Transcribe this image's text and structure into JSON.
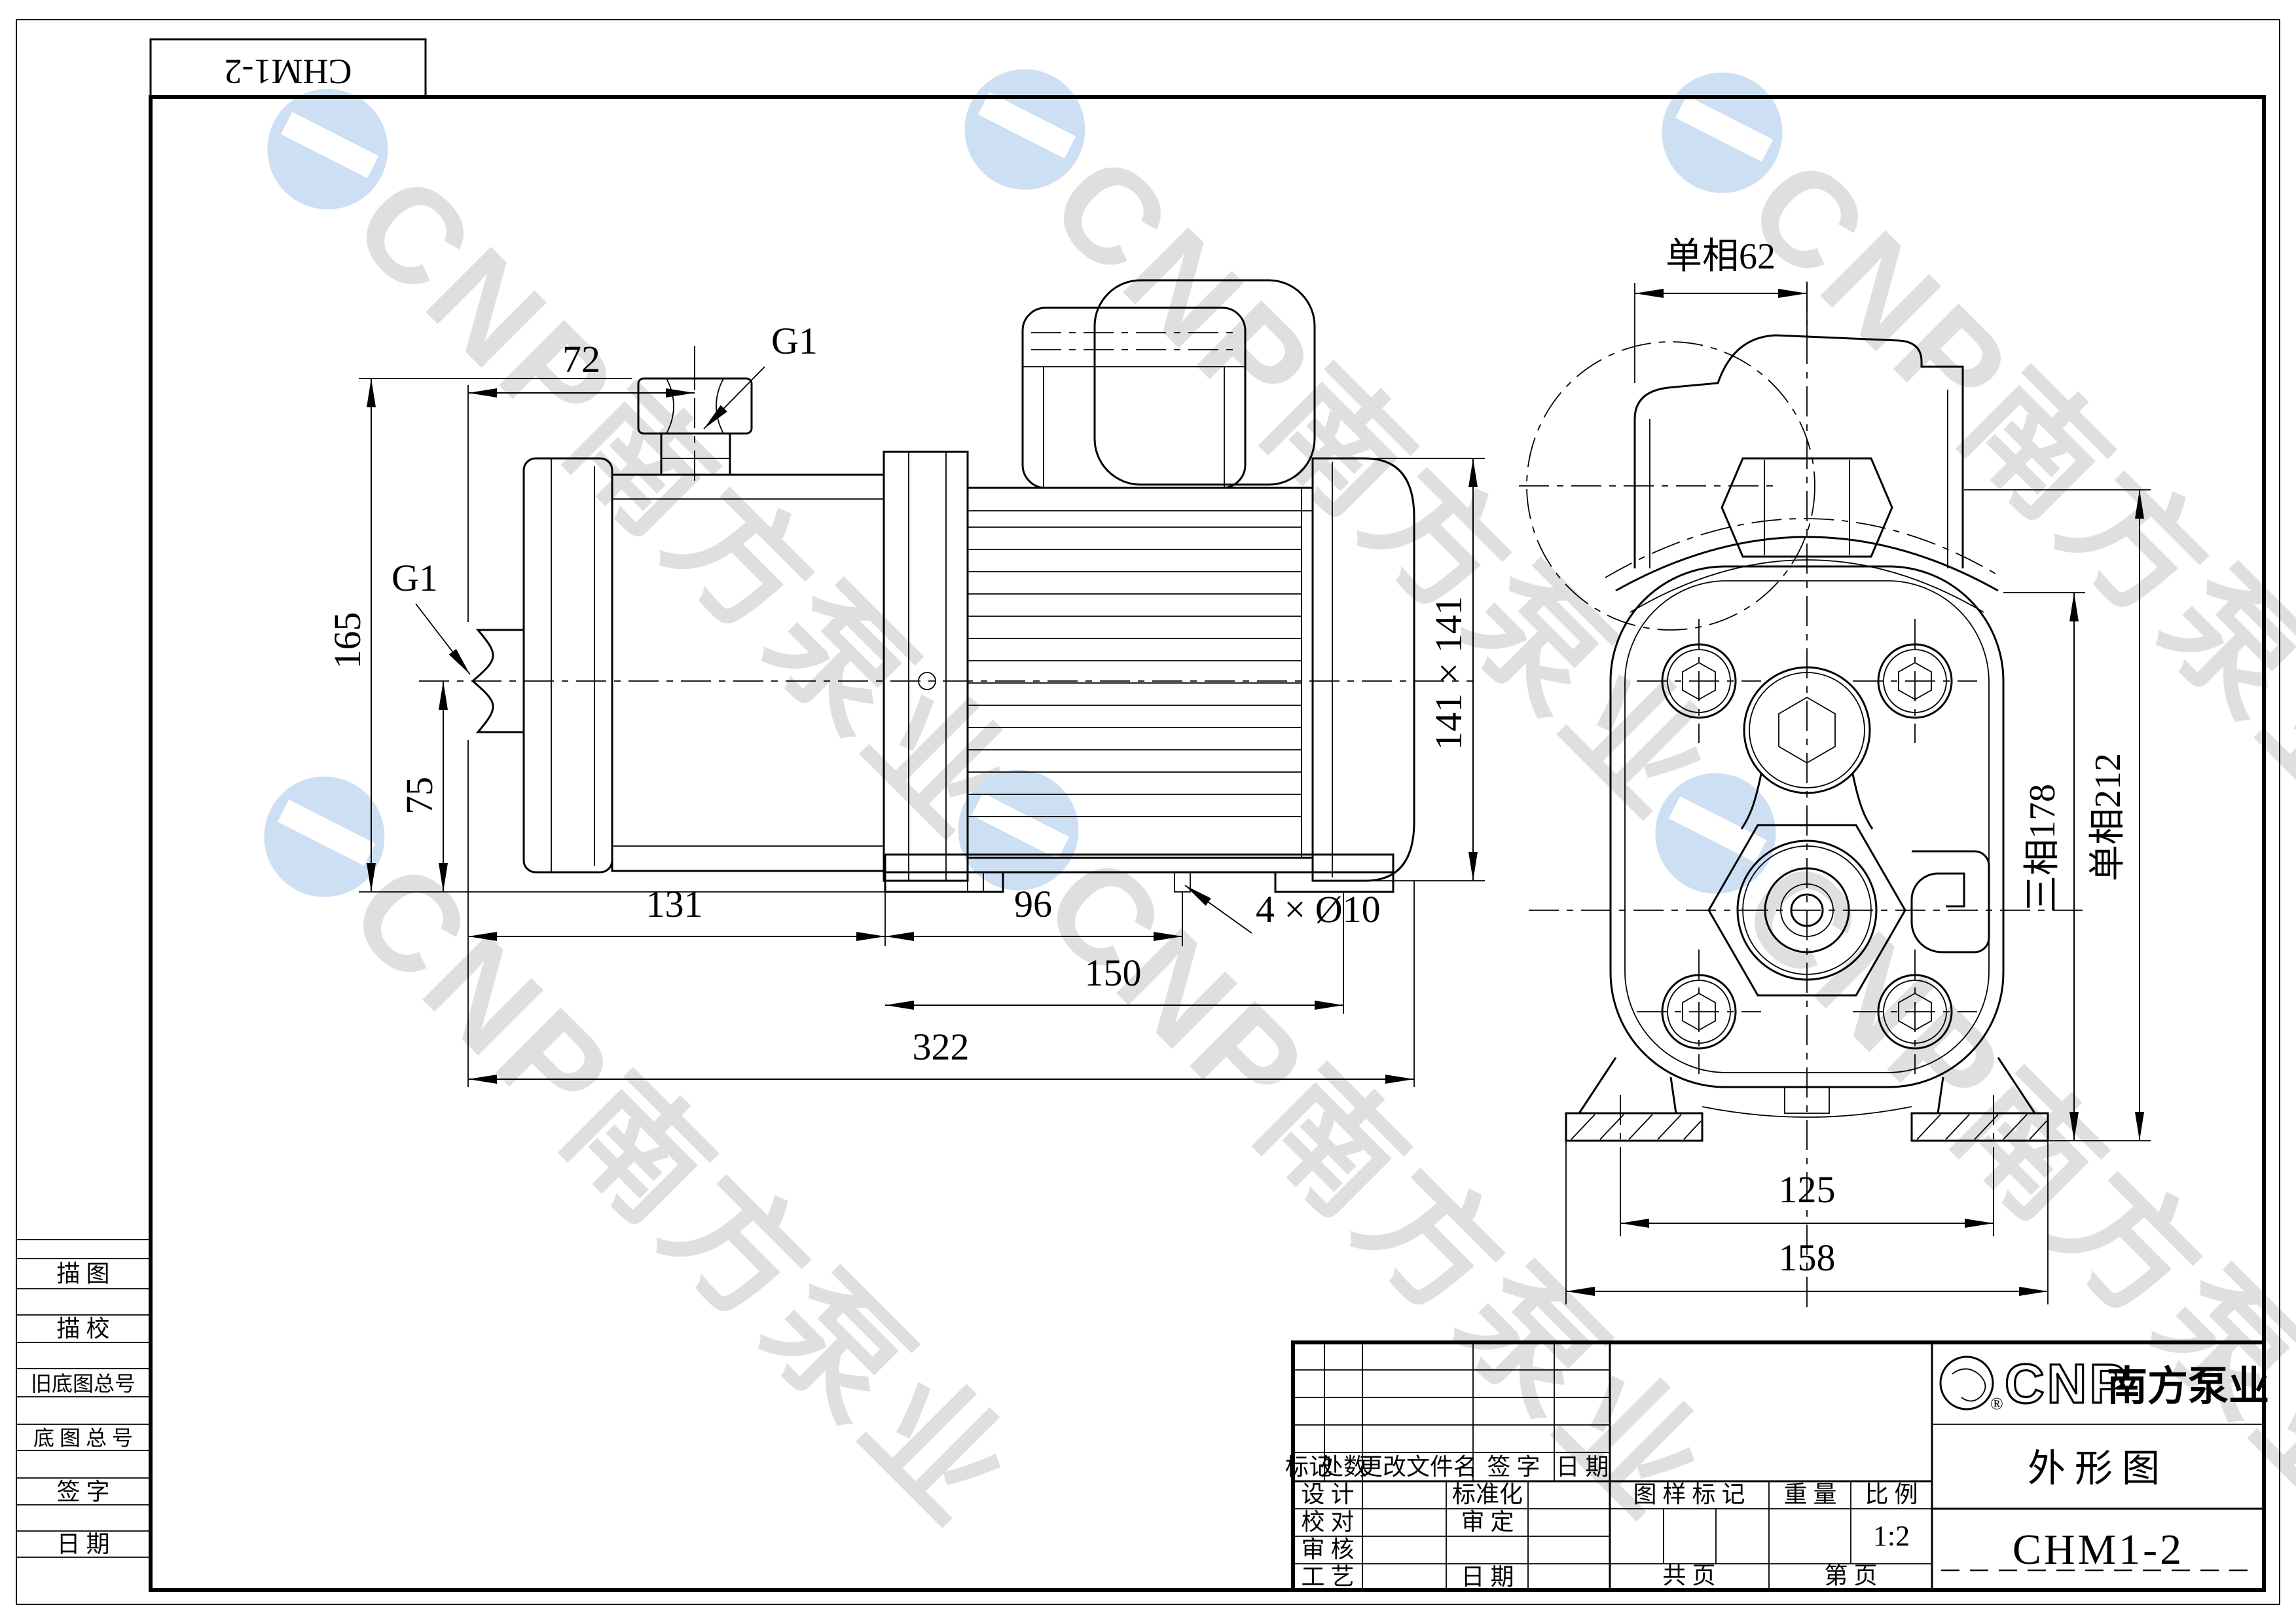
{
  "doc_box": {
    "model": "CHM1-2"
  },
  "watermark": {
    "brand": "CNP南方泵业"
  },
  "side_view": {
    "dim_72": "72",
    "g1_discharge": "G1",
    "g1_suction": "G1",
    "dim_165": "165",
    "dim_75": "75",
    "dim_141": "141 × 141",
    "dim_131": "131",
    "dim_96": "96",
    "dim_holes": "4 × Ø10",
    "dim_150": "150",
    "dim_322": "322"
  },
  "front_view": {
    "dim_top": "单相62",
    "dim_right_inner": "三相178",
    "dim_right_outer": "单相212",
    "dim_125": "125",
    "dim_158": "158"
  },
  "margin_table": {
    "rows": [
      "描  图",
      "描  校",
      "旧底图总号",
      "底 图 总 号",
      "签  字",
      "日  期"
    ]
  },
  "title_block": {
    "revision": {
      "mark": "标记",
      "count": "处数",
      "file": "更改文件名",
      "sign": "签  字",
      "date": "日  期"
    },
    "roles": {
      "design": "设  计",
      "check": "校  对",
      "review": "审  核",
      "process": "工  艺",
      "standardize": "标准化",
      "approve": "审  定",
      "date": "日  期"
    },
    "stamp": {
      "mark": "图 样 标 记",
      "weight": "重  量",
      "scale": "比  例",
      "scale_value": "1:2"
    },
    "pages": {
      "total": "共    页",
      "current": "第    页"
    },
    "brand": {
      "en": "CNP",
      "cn": "南方泵业"
    },
    "doc_type": "外形图",
    "model": "CHM1-2"
  }
}
